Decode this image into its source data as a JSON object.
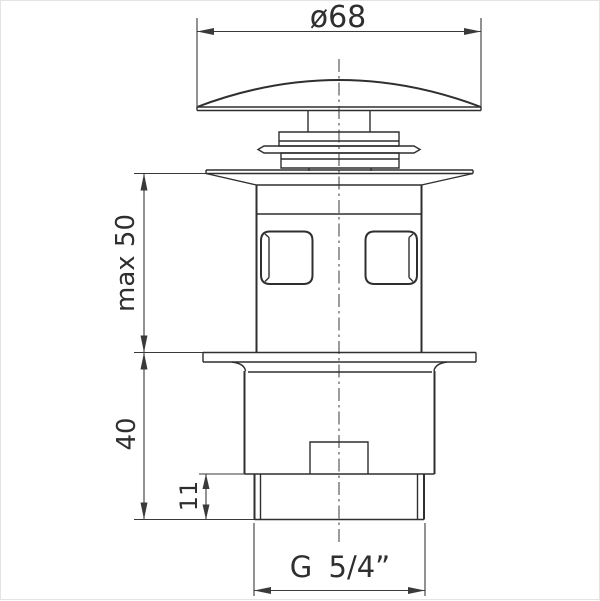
{
  "drawing": {
    "dimensions": {
      "diameter_label": "ø68",
      "max_height_label": "max 50",
      "body_height_label": "40",
      "thread_length_label": "11",
      "thread_size_label": "G 5/4”"
    },
    "colors": {
      "line": "#2f2f2f",
      "dimension_line": "#3a3a3a",
      "background": "#ffffff"
    }
  }
}
